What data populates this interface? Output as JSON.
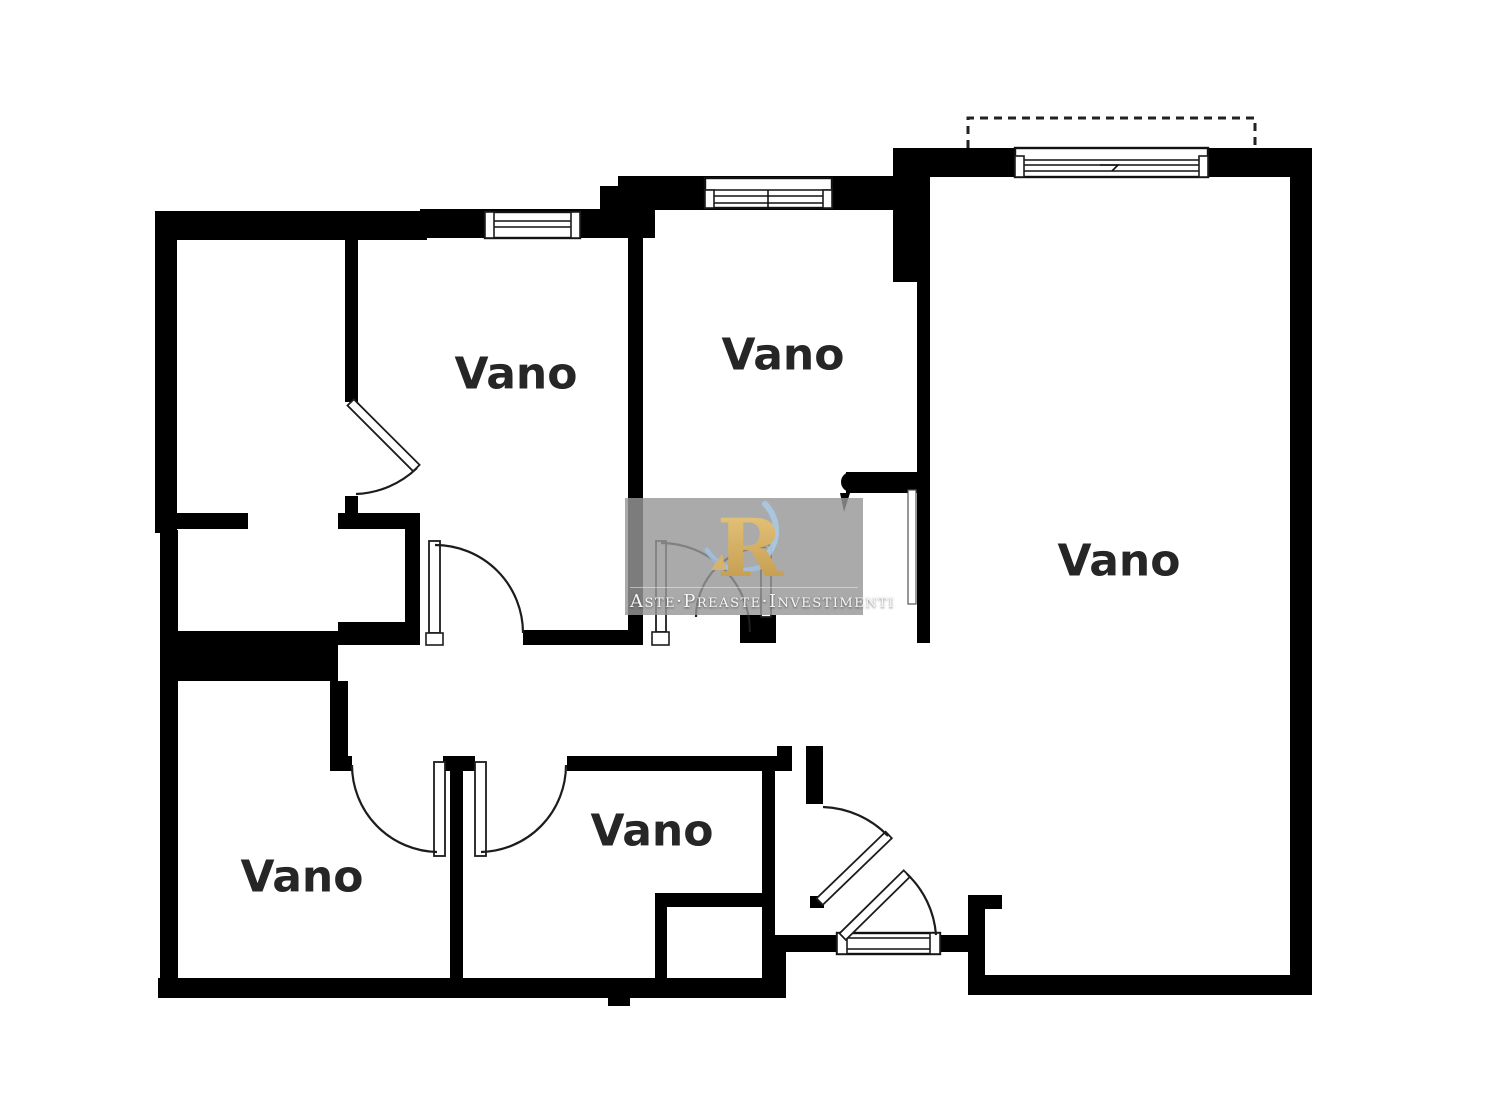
{
  "document": {
    "type": "floor-plan",
    "background": "#ffffff"
  },
  "rooms": [
    {
      "id": "room-top-left-bedroom",
      "label": "Vano"
    },
    {
      "id": "room-top-middle-bedroom",
      "label": "Vano"
    },
    {
      "id": "room-right-living",
      "label": "Vano"
    },
    {
      "id": "room-bottom-left",
      "label": "Vano"
    },
    {
      "id": "room-bottom-middle",
      "label": "Vano"
    }
  ],
  "watermark": {
    "logo_letter": "R",
    "tagline": "Aste·Preaste·Investimenti"
  },
  "colors": {
    "wall": "#000000",
    "door_line": "#1c1c1c",
    "label": "#262626",
    "watermark_bg": "#979797",
    "watermark_gold": "#d9b36a",
    "watermark_blue": "#a9cbe7",
    "watermark_text": "#f7f7f7"
  }
}
